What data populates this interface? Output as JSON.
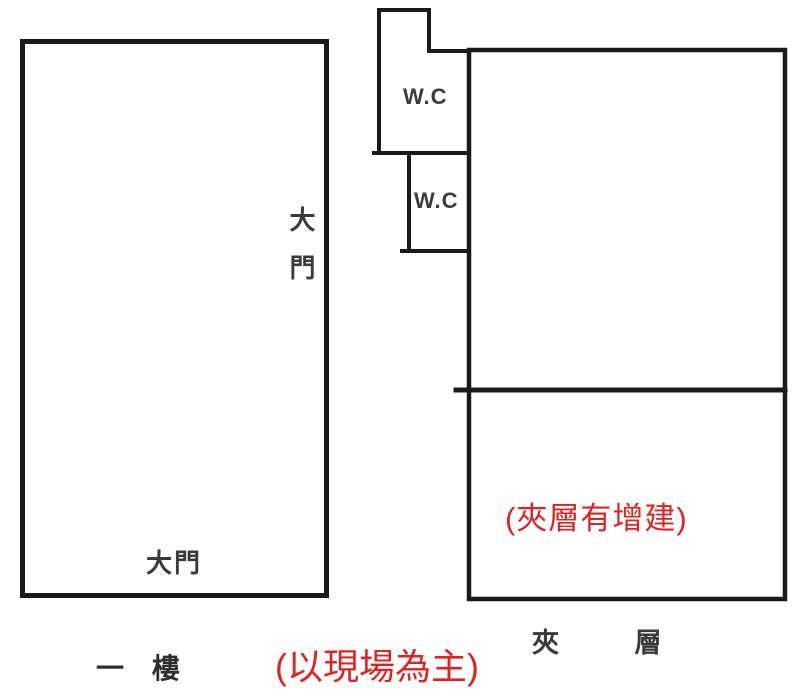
{
  "page": {
    "background": "#ffffff"
  },
  "colors": {
    "wall": "#1a1a1a",
    "label_text": "#3a3a3a",
    "annotation_red": "#dc2424"
  },
  "first_floor": {
    "side_door_label": "大門",
    "bottom_door_label": "大門",
    "name_label": "一 樓"
  },
  "wc": {
    "upper_label": "W.C",
    "lower_label": "W.C"
  },
  "mezzanine": {
    "annotation": "(夾層有增建)",
    "name_label": "夾 層"
  },
  "site_note": "(以現場為主)"
}
